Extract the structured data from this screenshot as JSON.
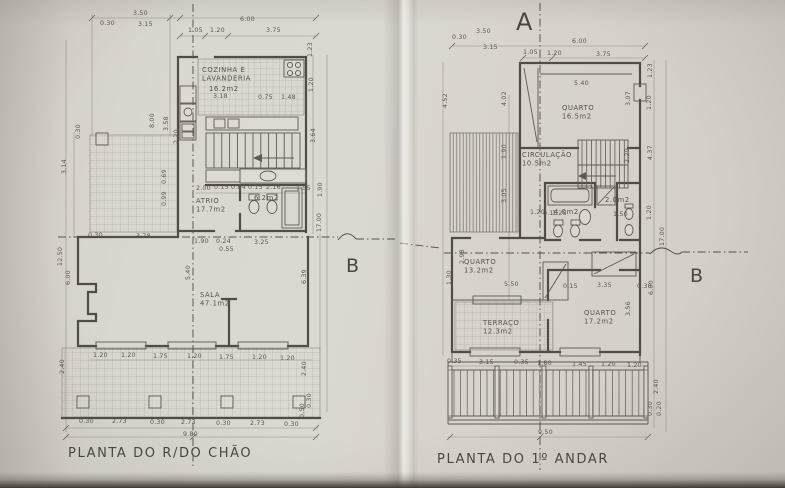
{
  "colors": {
    "paper": "#d8d4cd",
    "ink": "#504c46",
    "dim_ink": "#5b574f",
    "shadow": "#403c33"
  },
  "section_markers": [
    {
      "t": "A",
      "x": 516,
      "y": 30
    },
    {
      "t": "B",
      "x": 346,
      "y": 272
    },
    {
      "t": "B",
      "x": 690,
      "y": 282
    }
  ],
  "ground_floor": {
    "caption": "PLANTA DO R/DO CHÃO",
    "room_labels": [
      {
        "lines": [
          "COZINHA E",
          "LAVANDERIA"
        ],
        "x": 202,
        "y": 72
      },
      {
        "lines": [
          "16.2m2"
        ],
        "x": 209,
        "y": 91
      },
      {
        "lines": [
          "ATRIO",
          "17.7m2"
        ],
        "x": 196,
        "y": 203
      },
      {
        "lines": [
          "6.2m2"
        ],
        "x": 254,
        "y": 200
      },
      {
        "lines": [
          "SALA",
          "47.1m2"
        ],
        "x": 200,
        "y": 297
      }
    ],
    "dim_labels": [
      {
        "t": "3.50",
        "x": 133,
        "y": 15
      },
      {
        "t": "0.30",
        "x": 100,
        "y": 25
      },
      {
        "t": "3.15",
        "x": 138,
        "y": 26
      },
      {
        "t": "6.00",
        "x": 240,
        "y": 21
      },
      {
        "t": "1.05",
        "x": 188,
        "y": 32
      },
      {
        "t": "1.20",
        "x": 210,
        "y": 32
      },
      {
        "t": "3.75",
        "x": 266,
        "y": 32
      },
      {
        "t": "1.23",
        "x": 312,
        "y": 57,
        "r": -90
      },
      {
        "t": "1.20",
        "x": 313,
        "y": 92,
        "r": -90
      },
      {
        "t": "3.64",
        "x": 315,
        "y": 143,
        "r": -90
      },
      {
        "t": "1.90",
        "x": 322,
        "y": 197,
        "r": -90
      },
      {
        "t": "17.00",
        "x": 321,
        "y": 232,
        "r": -90
      },
      {
        "t": "0.30",
        "x": 80,
        "y": 139,
        "r": -90
      },
      {
        "t": "3.14",
        "x": 66,
        "y": 174,
        "r": -90
      },
      {
        "t": "8.00",
        "x": 154,
        "y": 128,
        "r": -90
      },
      {
        "t": "3.58",
        "x": 168,
        "y": 131,
        "r": -90
      },
      {
        "t": "2.20",
        "x": 178,
        "y": 144,
        "r": -90
      },
      {
        "t": "0.69",
        "x": 166,
        "y": 184,
        "r": -90
      },
      {
        "t": "0.99",
        "x": 166,
        "y": 206,
        "r": -90
      },
      {
        "t": "3.18",
        "x": 213,
        "y": 98
      },
      {
        "t": "0.75",
        "x": 258,
        "y": 99
      },
      {
        "t": "1.48",
        "x": 281,
        "y": 99
      },
      {
        "t": "2.00",
        "x": 196,
        "y": 190
      },
      {
        "t": "0.15 0.84 0.15",
        "x": 214,
        "y": 189
      },
      {
        "t": "2.16",
        "x": 266,
        "y": 189
      },
      {
        "t": "1.55",
        "x": 296,
        "y": 190
      },
      {
        "t": "0.30",
        "x": 88,
        "y": 237
      },
      {
        "t": "3.78",
        "x": 136,
        "y": 238
      },
      {
        "t": "1.90",
        "x": 194,
        "y": 243
      },
      {
        "t": "0.24",
        "x": 216,
        "y": 243
      },
      {
        "t": "3.25",
        "x": 254,
        "y": 244
      },
      {
        "t": "0.55",
        "x": 219,
        "y": 251
      },
      {
        "t": "12.50",
        "x": 62,
        "y": 266,
        "r": -90
      },
      {
        "t": "6.00",
        "x": 70,
        "y": 285,
        "r": -90
      },
      {
        "t": "2.40",
        "x": 64,
        "y": 374,
        "r": -90
      },
      {
        "t": "5.40",
        "x": 190,
        "y": 280,
        "r": -90
      },
      {
        "t": "6.39",
        "x": 306,
        "y": 284,
        "r": -90
      },
      {
        "t": "2.40",
        "x": 306,
        "y": 376,
        "r": -90
      },
      {
        "t": "1.20",
        "x": 93,
        "y": 357
      },
      {
        "t": "1.20",
        "x": 121,
        "y": 357
      },
      {
        "t": "1.75",
        "x": 153,
        "y": 358
      },
      {
        "t": "1.20",
        "x": 187,
        "y": 358
      },
      {
        "t": "1.75",
        "x": 219,
        "y": 359
      },
      {
        "t": "1.20",
        "x": 252,
        "y": 359
      },
      {
        "t": "1.20",
        "x": 280,
        "y": 360
      },
      {
        "t": "0.30",
        "x": 79,
        "y": 423
      },
      {
        "t": "2.73",
        "x": 112,
        "y": 423
      },
      {
        "t": "0.30",
        "x": 150,
        "y": 424
      },
      {
        "t": "2.73",
        "x": 181,
        "y": 424
      },
      {
        "t": "0.30",
        "x": 216,
        "y": 425
      },
      {
        "t": "2.73",
        "x": 250,
        "y": 425
      },
      {
        "t": "0.30",
        "x": 284,
        "y": 426
      },
      {
        "t": "9.80",
        "x": 183,
        "y": 436
      },
      {
        "t": "0.50",
        "x": 304,
        "y": 418,
        "r": -90
      },
      {
        "t": "0.30",
        "x": 311,
        "y": 408,
        "r": -90
      }
    ]
  },
  "first_floor": {
    "caption": "PLANTA DO 1º ANDAR",
    "room_labels": [
      {
        "lines": [
          "QUARTO",
          "16.5m2"
        ],
        "x": 562,
        "y": 110
      },
      {
        "lines": [
          "CIRCULAÇÃO",
          "10.5m2"
        ],
        "x": 522,
        "y": 157
      },
      {
        "lines": [
          "4.0m2"
        ],
        "x": 554,
        "y": 214
      },
      {
        "lines": [
          "2.0m2"
        ],
        "x": 605,
        "y": 202
      },
      {
        "lines": [
          "QUARTO",
          "13.2m2"
        ],
        "x": 464,
        "y": 264
      },
      {
        "lines": [
          "TERRAÇO",
          "12.3m2"
        ],
        "x": 483,
        "y": 325
      },
      {
        "lines": [
          "QUARTO",
          "17.2m2"
        ],
        "x": 584,
        "y": 315
      }
    ],
    "dim_labels": [
      {
        "t": "3.50",
        "x": 476,
        "y": 33
      },
      {
        "t": "0.30",
        "x": 452,
        "y": 39
      },
      {
        "t": "3.15",
        "x": 483,
        "y": 49
      },
      {
        "t": "6.00",
        "x": 572,
        "y": 43
      },
      {
        "t": "1.05",
        "x": 523,
        "y": 54
      },
      {
        "t": "1.20",
        "x": 547,
        "y": 55
      },
      {
        "t": "3.75",
        "x": 596,
        "y": 56
      },
      {
        "t": "5.40",
        "x": 574,
        "y": 85
      },
      {
        "t": "1.23",
        "x": 652,
        "y": 78,
        "r": -90
      },
      {
        "t": "3.07",
        "x": 630,
        "y": 106,
        "r": -90
      },
      {
        "t": "1.20",
        "x": 651,
        "y": 110,
        "r": -90
      },
      {
        "t": "4.37",
        "x": 652,
        "y": 160,
        "r": -90
      },
      {
        "t": "2.20",
        "x": 629,
        "y": 163,
        "r": -90
      },
      {
        "t": "1.20",
        "x": 651,
        "y": 220,
        "r": -90
      },
      {
        "t": "17.00",
        "x": 664,
        "y": 246,
        "r": -90
      },
      {
        "t": "4.52",
        "x": 447,
        "y": 108,
        "r": -90
      },
      {
        "t": "4.02",
        "x": 506,
        "y": 106,
        "r": -90
      },
      {
        "t": "1.90",
        "x": 506,
        "y": 159,
        "r": -90
      },
      {
        "t": "3.05",
        "x": 506,
        "y": 203,
        "r": -90
      },
      {
        "t": "2.98",
        "x": 464,
        "y": 264,
        "r": -90
      },
      {
        "t": "1.30",
        "x": 451,
        "y": 285,
        "r": -90
      },
      {
        "t": "1.20",
        "x": 530,
        "y": 214
      },
      {
        "t": "0.15",
        "x": 543,
        "y": 215
      },
      {
        "t": "1.25",
        "x": 552,
        "y": 215
      },
      {
        "t": "1.50",
        "x": 613,
        "y": 216
      },
      {
        "t": "5.50",
        "x": 504,
        "y": 286
      },
      {
        "t": "0.15",
        "x": 563,
        "y": 288
      },
      {
        "t": "3.35",
        "x": 597,
        "y": 287
      },
      {
        "t": "0.30",
        "x": 637,
        "y": 288
      },
      {
        "t": "3.56",
        "x": 630,
        "y": 316,
        "r": -90
      },
      {
        "t": "6.00",
        "x": 653,
        "y": 295,
        "r": -90
      },
      {
        "t": "0.35",
        "x": 447,
        "y": 363
      },
      {
        "t": "3.15",
        "x": 479,
        "y": 364
      },
      {
        "t": "0.35",
        "x": 514,
        "y": 364
      },
      {
        "t": "1.80",
        "x": 537,
        "y": 365
      },
      {
        "t": "1.45",
        "x": 572,
        "y": 366
      },
      {
        "t": "1.20",
        "x": 601,
        "y": 366
      },
      {
        "t": "1.20",
        "x": 627,
        "y": 367
      },
      {
        "t": "9.50",
        "x": 538,
        "y": 434
      },
      {
        "t": "2.40",
        "x": 658,
        "y": 394,
        "r": -90
      },
      {
        "t": "0.30",
        "x": 652,
        "y": 416,
        "r": -90
      },
      {
        "t": "0.20",
        "x": 661,
        "y": 416,
        "r": -90
      }
    ]
  }
}
